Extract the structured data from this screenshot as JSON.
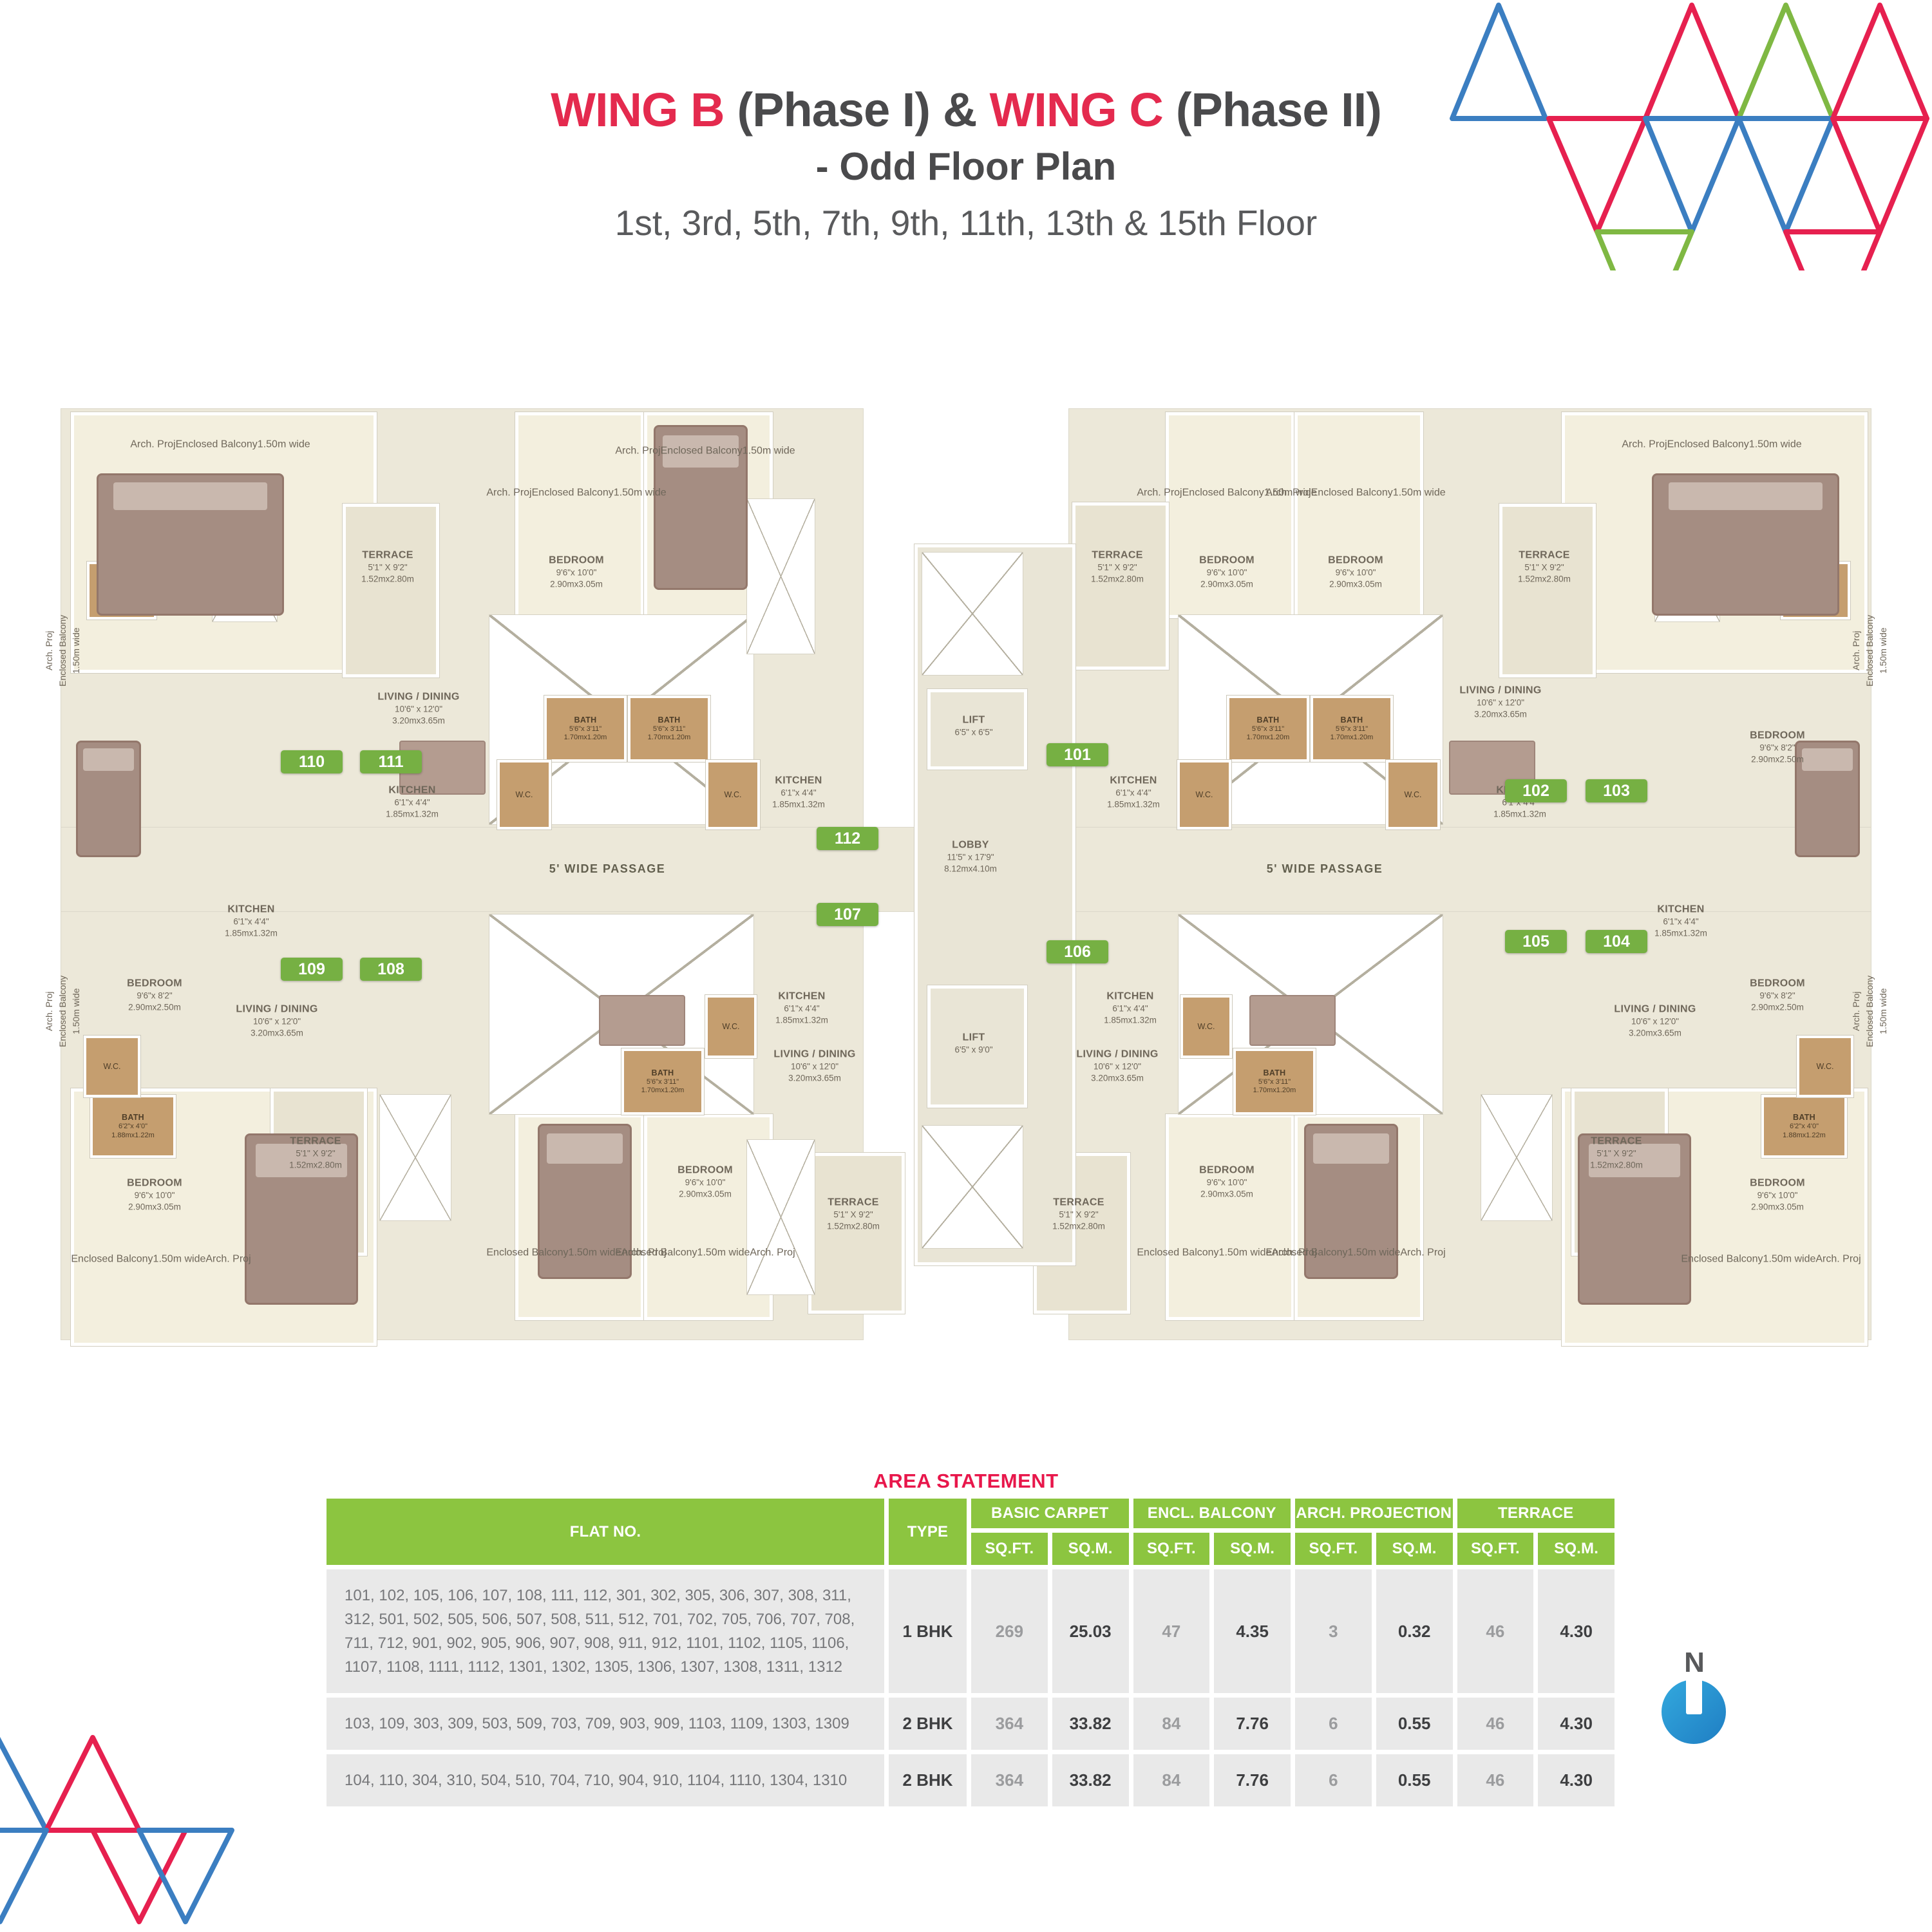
{
  "title": {
    "wing_b": "WING B",
    "phase_1": "(Phase I)",
    "amp": "&",
    "wing_c": "WING C",
    "phase_2": "(Phase II)",
    "subtitle": "- Odd Floor Plan",
    "floors": "1st, 3rd, 5th, 7th, 9th, 11th, 13th & 15th Floor"
  },
  "plan": {
    "labels": {
      "arch": "Arch. Proj",
      "encl": "Enclosed Balcony",
      "w150": "1.50m wide",
      "passage": "5' WIDE PASSAGE",
      "terrace": {
        "n": "TERRACE",
        "ft": "5'1\" X 9'2\"",
        "m": "1.52mx2.80m"
      },
      "bedroom": {
        "n": "BEDROOM",
        "ft": "9'6\"x 10'0\"",
        "m": "2.90mx3.05m"
      },
      "bedroom_sm": {
        "n": "BEDROOM",
        "ft": "9'6\"x 8'2\"",
        "m": "2.90mx2.50m"
      },
      "living": {
        "n": "LIVING / DINING",
        "ft": "10'6\" x 12'0\"",
        "m": "3.20mx3.65m"
      },
      "kitchen": {
        "n": "KITCHEN",
        "ft": "6'1\"x 4'4\"",
        "m": "1.85mx1.32m"
      },
      "bath": {
        "n": "BATH",
        "ft": "5'6\"x 3'11\"",
        "m": "1.70mx1.20m"
      },
      "bath2": {
        "n": "BATH",
        "ft": "6'2\"x 4'0\"",
        "m": "1.88mx1.22m"
      },
      "wc": "W.C.",
      "lift_a": {
        "n": "LIFT",
        "ft": "6'5\" x 6'5\""
      },
      "lift_b": {
        "n": "LIFT",
        "ft": "6'5\" x 9'0\""
      },
      "lobby": {
        "n": "LOBBY",
        "ft": "11'5\" x 17'9\"",
        "m": "8.12mx4.10m"
      }
    },
    "flats": {
      "f101": "101",
      "f102": "102",
      "f103": "103",
      "f104": "104",
      "f105": "105",
      "f106": "106",
      "f107": "107",
      "f108": "108",
      "f109": "109",
      "f110": "110",
      "f111": "111",
      "f112": "112"
    }
  },
  "compass": {
    "n": "N"
  },
  "area_table": {
    "title": "AREA STATEMENT",
    "flat_no": "FLAT NO.",
    "type": "TYPE",
    "groups": [
      "BASIC CARPET",
      "ENCL. BALCONY",
      "ARCH. PROJECTION",
      "TERRACE"
    ],
    "sqft": "SQ.FT.",
    "sqm": "SQ.M.",
    "rows": [
      {
        "flats": "101, 102, 105, 106, 107, 108, 111, 112, 301, 302, 305, 306, 307, 308, 311, 312, 501, 502, 505, 506, 507, 508, 511, 512, 701, 702, 705, 706, 707, 708, 711, 712, 901, 902, 905, 906, 907, 908, 911, 912, 1101, 1102, 1105, 1106, 1107, 1108, 1111, 1112, 1301, 1302, 1305, 1306, 1307, 1308, 1311, 1312",
        "type": "1 BHK",
        "v": [
          "269",
          "25.03",
          "47",
          "4.35",
          "3",
          "0.32",
          "46",
          "4.30"
        ]
      },
      {
        "flats": "103, 109, 303, 309, 503, 509, 703, 709, 903, 909, 1103, 1109, 1303, 1309",
        "type": "2 BHK",
        "v": [
          "364",
          "33.82",
          "84",
          "7.76",
          "6",
          "0.55",
          "46",
          "4.30"
        ]
      },
      {
        "flats": "104, 110, 304, 310, 504, 510, 704, 710, 904, 910, 1104, 1110, 1304, 1310",
        "type": "2 BHK",
        "v": [
          "364",
          "33.82",
          "84",
          "7.76",
          "6",
          "0.55",
          "46",
          "4.30"
        ]
      }
    ]
  },
  "colors": {
    "accent_red": "#E42A4E",
    "badge_green": "#76B043",
    "header_green": "#8CC540",
    "compass_blue": "#2B9CD8"
  }
}
